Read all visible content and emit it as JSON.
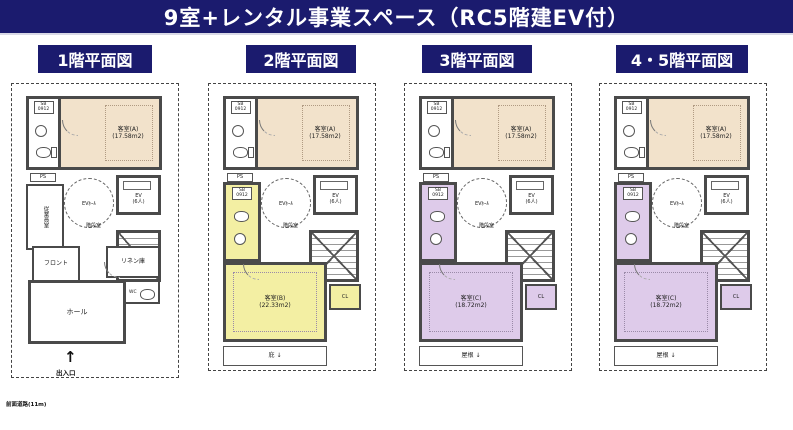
{
  "title": "9室+レンタル事業スペース（RC5階建EV付）",
  "road_label": "前面道路(11m)",
  "colors": {
    "navy": "#1b1b6e",
    "beige": "#f2e2cb",
    "yellow": "#f3efa3",
    "purple": "#decbea",
    "wall": "#4a4a4a"
  },
  "floors": [
    {
      "label": "1階平面図",
      "guest_a": "客室(A)",
      "guest_a_area": "(17.58m2)",
      "sb_unit": "SB 0912",
      "ps": "PS",
      "ev_hall": "EVﾎｰﾙ",
      "ev": "EV",
      "ev_capacity": "(6人)",
      "stair": "階段室",
      "staff_room": "従業員室",
      "front_desk": "フロント",
      "linen": "リネン庫",
      "wc": "WC",
      "hall": "ホール",
      "entrance_arrow": "↑",
      "entrance": "出入口"
    },
    {
      "label": "2階平面図",
      "guest_a": "客室(A)",
      "guest_a_area": "(17.58m2)",
      "sb_unit": "SB 0912",
      "sb_unit2": "SB 0912",
      "ps": "PS",
      "ev_hall": "EVﾎｰﾙ",
      "ev": "EV",
      "ev_capacity": "(6人)",
      "stair": "階段室",
      "guest": "客室(B)",
      "guest_area": "(22.33m2)",
      "closet": "CL",
      "canopy": "庇 ↓"
    },
    {
      "label": "3階平面図",
      "guest_a": "客室(A)",
      "guest_a_area": "(17.58m2)",
      "sb_unit": "SB 0912",
      "sb_unit2": "SB 0912",
      "ps": "PS",
      "ev_hall": "EVﾎｰﾙ",
      "ev": "EV",
      "ev_capacity": "(6人)",
      "stair": "階段室",
      "guest": "客室(C)",
      "guest_area": "(18.72m2)",
      "closet": "CL",
      "canopy": "屋根 ↓"
    },
    {
      "label": "4・5階平面図",
      "guest_a": "客室(A)",
      "guest_a_area": "(17.58m2)",
      "sb_unit": "SB 0912",
      "sb_unit2": "SB 0912",
      "ps": "PS",
      "ev_hall": "EVﾎｰﾙ",
      "ev": "EV",
      "ev_capacity": "(6人)",
      "stair": "階段室",
      "guest": "客室(C)",
      "guest_area": "(18.72m2)",
      "closet": "CL",
      "canopy": "屋根 ↓"
    }
  ]
}
